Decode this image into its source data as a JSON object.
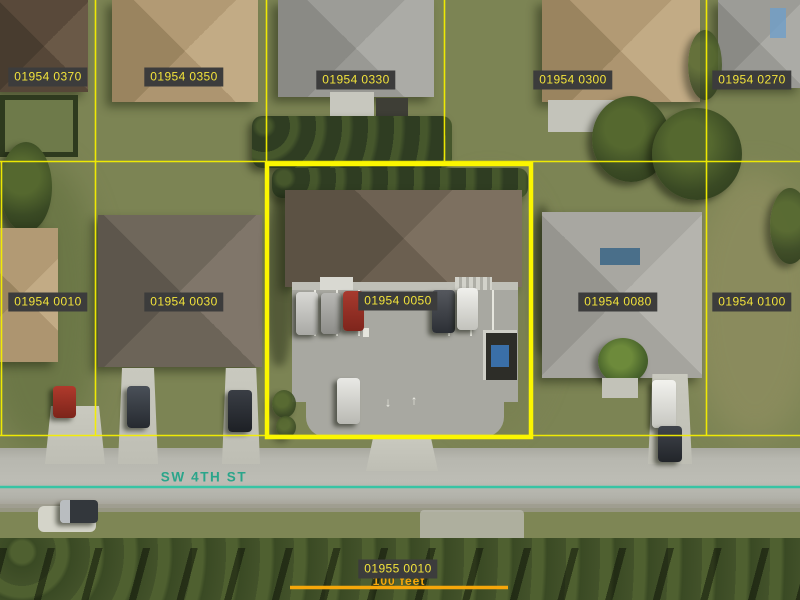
{
  "map": {
    "type": "aerial-parcel-map",
    "street": {
      "label": "SW 4TH ST"
    },
    "scale_bar": {
      "label": "100 feet"
    },
    "selected_parcel_id": "01954 0050",
    "parcel_labels": [
      {
        "id": "01954 0370",
        "x": 48,
        "y": 77
      },
      {
        "id": "01954 0350",
        "x": 184,
        "y": 77
      },
      {
        "id": "01954 0330",
        "x": 356,
        "y": 80
      },
      {
        "id": "01954 0300",
        "x": 573,
        "y": 80
      },
      {
        "id": "01954 0270",
        "x": 752,
        "y": 80
      },
      {
        "id": "01954 0010",
        "x": 48,
        "y": 302
      },
      {
        "id": "01954 0030",
        "x": 184,
        "y": 302
      },
      {
        "id": "01954 0050",
        "x": 398,
        "y": 301,
        "selected": true
      },
      {
        "id": "01954 0080",
        "x": 618,
        "y": 302
      },
      {
        "id": "01954 0100",
        "x": 752,
        "y": 302
      },
      {
        "id": "01955 0010",
        "x": 398,
        "y": 569
      }
    ],
    "pavement_markings": {
      "arrow_down": "↓",
      "arrow_up": "↑"
    },
    "colors": {
      "parcel_line": "#f5ef00",
      "selected_outline": "#fbf600",
      "label_bg": "#3c3c3c",
      "label_text": "#f2e33b",
      "street_line": "#38c4a4",
      "street_text": "#2aa58a",
      "scale_bar": "#f6a70a"
    }
  }
}
